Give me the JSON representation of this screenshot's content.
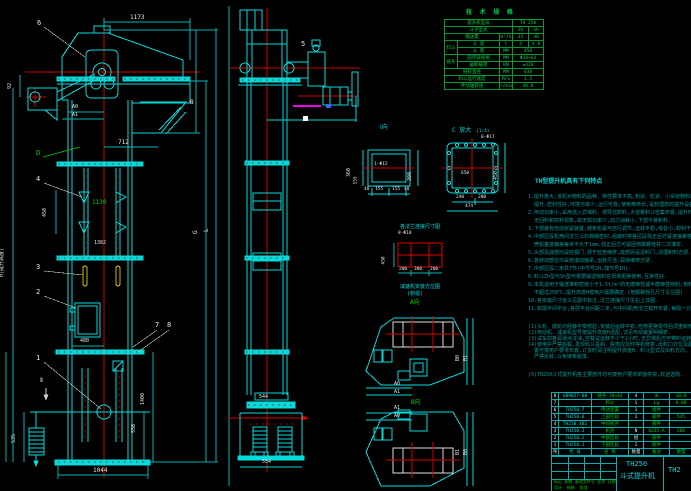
{
  "doc": {
    "model": "TH250",
    "name": "斗式提升机",
    "drawing_no_partial": "TH2"
  },
  "spec": {
    "title": "技 术 规 格",
    "model_label": "提升机型号",
    "model_value": "TH 250",
    "type_label": "斗子型式",
    "type_v1": "Zh",
    "type_v2": "Sh",
    "cap_label": "输送量",
    "cap_unit": "m³/h",
    "cap_v1": "35",
    "cap_v2": "48",
    "bucket_group": "料斗",
    "vol_label": "斗 容",
    "vol_unit": "l",
    "vol_v1": "3",
    "vol_v2": "4.8",
    "pitch_label": "斗 距",
    "pitch_unit": "MM",
    "pitch_value": "450",
    "chain_group": "链条",
    "chain_label": "圆环链规格",
    "chain_unit": "MM",
    "chain_value": "Φ18×64",
    "load_label": "破断载荷",
    "load_unit": "KN",
    "load_value": "≥320",
    "wheel_label": "链轮直径",
    "wheel_unit": "MM",
    "wheel_value": "630",
    "speed_label": "料斗运行速度",
    "speed_unit": "M/S",
    "speed_value": "1.5",
    "rpm_label": "传动轴转速",
    "rpm_unit": "r/min",
    "rpm_value": "48.0"
  },
  "notes": {
    "title": "TH型提升机具有下列特点",
    "lines": [
      "1.提升量大,该机对物料的品种、特性要求不高,粉状、粒状、小块状物料均可",
      "  提升,密封性好,环境污染少,运行可靠,使用寿命长,是较理想的提升设备.",
      "2.传动功率小,采用流入式喂料、诱导式卸料,大容量料斗密集布置,提升时几乎",
      "  无回料和挖料现象,故无效功率少,动力消耗小,下部不易积料.",
      "3.下部装有自动张紧装置,链条松紧可自行调节,运转平稳,噪音小,卸料干净.",
      "4.中部区段机壳间法兰以石棉绳密封,组装时将各区段找正后拧紧连接螺栓,机",
      "  壳铅垂度偏差每米不大于1mm,找正后方可紧固地脚螺栓并二次灌浆.",
      "5.头部及底部均设检视门,便于检查维修,底部另设清料门,清理积料方便.",
      "6.各转动部位均采用滚动轴承,运转灵活,润滑维修方便.",
      "7.中部区段二米共7节(中节号2H,端节号1H).",
      "8.料斗Zh型与Sh型可根据输送物料在现场更换使用,互换性好.",
      "9.本机适用于输送堆积密度小于1.5t/m³的无磨琢性或半磨琢性物料,物料温度",
      "  不超过250℃,提升高度H按用户需要确定.(地脚螺栓孔尺寸见左图)",
      "10.各安装尺寸含义见图中标注,法兰连接尺寸见右上详图.",
      "11.如需中间平台,各层平台间距二米,与中间机壳法兰错开布置,每隔一只.",
      "(1)头轮、底轮均经静平衡校验,安装后运转平稳,检修更换零件后须重新校验.",
      "(2)电动机、减速机型号按提升高度H选配,详见传动装置明细表.",
      "(3)试车前各润滑点注油,空载试运转不少于2小时,无异常后方可带料运转.",
      "(4)使用中严禁超载,发现料斗歪斜、脱落应及时停机修复,出料口方位及驱动位",
      "  置可按用户要求布置,订货时请注明提升高度H、料斗型式及出料方向.",
      "  严禁反转,以免链条脱落.",
      "(5)TH250斗式提升机各主要部件均可按用户要求单独供货,欢迎选购."
    ]
  },
  "bom": {
    "headers": {
      "no": "序",
      "code": "代 号",
      "name": "名 称",
      "qty": "数量",
      "note": "备注",
      "wt": "重量"
    },
    "rows": [
      {
        "no": "8",
        "code": "GB9027-88",
        "name": "链条 18×64",
        "qty": "4",
        "note": "米",
        "wt": "10.8"
      },
      {
        "no": "7",
        "code": "",
        "name": "料斗",
        "qty": "1",
        "note": "Lg",
        "wt": "0.08"
      },
      {
        "no": "6",
        "code": "TH250.7",
        "name": "传动装置",
        "qty": "1",
        "note": "组件",
        "wt": ""
      },
      {
        "no": "5",
        "code": "TH250.6",
        "name": "上部区段",
        "qty": "1",
        "note": "部件",
        "wt": "535"
      },
      {
        "no": "4",
        "code": "TH250.4B1",
        "name": "中间机壳",
        "qty": "",
        "note": "部件",
        "wt": ""
      },
      {
        "no": "3",
        "code": "TH250.3",
        "name": "机壳",
        "qty": "N",
        "note": "Q235-A",
        "wt": "206"
      },
      {
        "no": "2",
        "code": "TH250.2",
        "name": "中部区段",
        "qty": "组",
        "note": "部件",
        "wt": ""
      },
      {
        "no": "1",
        "code": "TH250.1",
        "name": "下部区段",
        "qty": "1",
        "note": "部件",
        "wt": ""
      }
    ]
  },
  "titleblock": {
    "model": "TH250",
    "name": "斗式提升机",
    "no": "TH2",
    "rev": "标记 处数 更改文件号 签字 日期",
    "sign": "设计  校核  批准"
  },
  "labels": {
    "p1": "1",
    "p2": "2",
    "p3": "3",
    "p4": "4",
    "p5": "5",
    "p6": "6",
    "p7": "7",
    "p8": "8",
    "pd": "D",
    "sec2": "Ⅱ",
    "view_i": "Ⅰ向",
    "view_a": "A向",
    "view_b": "B向",
    "detail_c": "C 放大",
    "detail_c_scale": "(1:4)",
    "bolts_c": "8-Φ17",
    "bolts_grid": "8-Φ18",
    "cap1": "各法兰连接尺寸图",
    "cap2a": "减速机安装方位图",
    "cap2b": "(俯视)"
  },
  "dims": {
    "hw": "1173",
    "chute": "712",
    "a0": "A0",
    "a1": "A1",
    "b": "B",
    "g": "G",
    "l": "L",
    "h": "H(提升高度)",
    "d92": "92",
    "mid1130": "1130",
    "mid1382": "1382",
    "d450": "450",
    "d480": "480",
    "d1335": "1335",
    "d535": "535",
    "d1400": "1400",
    "d550": "550",
    "base": "1044",
    "side544": "544",
    "side554": "554",
    "fi360": "360",
    "fi155": "155",
    "fi300": "300",
    "fib1": "40",
    "fib2": "155",
    "fib3": "155",
    "fib4": "40",
    "fimark": "1-Φ12",
    "fc450": "450",
    "fc650": "650",
    "fc240": "240",
    "fc200": "200",
    "fc474": "474",
    "g450": "450",
    "g200a": "200",
    "g300": "300",
    "g200b": "200",
    "pa0": "A0",
    "pa1": "A1",
    "pb0": "B0",
    "pb1": "B1",
    "qa1": "A1",
    "qa0": "A0",
    "qb1": "B1",
    "qb0": "B0"
  }
}
